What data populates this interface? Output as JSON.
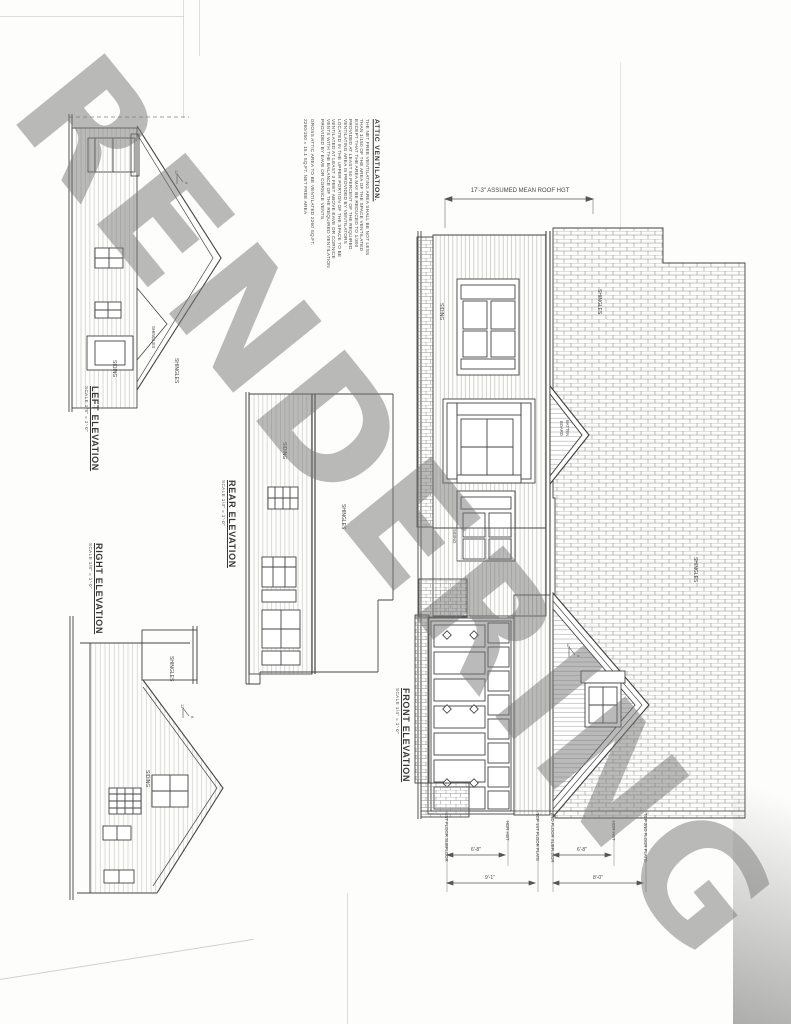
{
  "watermark": "RENDERING",
  "attic_note": {
    "title": "ATTIC VENTILATION.",
    "body_lines": [
      "THE NET FREE VENTILATING AREA SHALL BE NOT LESS",
      "THAN 1/150 OF THE AREA OF THE SPACE VENTILATED",
      "EXCEPT THAT THE AREA MAY BE REDUCED TO 1/300",
      "PROVIDED AT LEAST 50 PERCENT OF THE REQUIRED",
      "VENTILATING AREA IS PROVIDED BY VENTILATORS",
      "LOCATED IN THE UPPER PORTION OF THE SPACE TO BE",
      "VENTILATED AT LEAST 3 FEET ABOVE EAVE OR CORNICE",
      "VENTS WITH THE BALANCE OF THE REQUIRED VENTILATION",
      "PROVIDED BY EAVE OR CORNICE VENTS."
    ],
    "calc_line1": "GROSS ATTIC AREA TO BE VENTILATED 2260 SQ.FT.",
    "calc_line2": "2260/150 = 15.1 SQ.FT. NET FREE AREA"
  },
  "elevations": {
    "left": {
      "title": "LEFT ELEVATION",
      "scale": "SCALE 1/8\" = 1'-0\""
    },
    "right": {
      "title": "RIGHT ELEVATION",
      "scale": "SCALE 1/8\" = 1'-0\""
    },
    "rear": {
      "title": "REAR ELEVATION",
      "scale": "SCALE 1/4\" = 1'-0\""
    },
    "front": {
      "title": "FRONT ELEVATION",
      "scale": "SCALE 1/4\" = 1'-0\""
    }
  },
  "labels": {
    "siding": "SIDING",
    "shingles": "SHINGLES",
    "board": "BOARD",
    "batten": "BATTEN"
  },
  "pitch": {
    "run": "12",
    "rise": "8"
  },
  "dimensions": {
    "roof_height": "17'-3\" ASSUMED MEAN ROOF HGT",
    "first_subfloor": "1ST FLOOR SUBFLOOR",
    "hdr_hgt": "HDR HGT",
    "hdr_dim": "6'-8\"",
    "first_plate": "TOP 1ST FLOOR PLATE",
    "first_height": "9'-1\"",
    "second_subfloor": "2ND FLOOR SUBFLOOR",
    "second_plate": "TOP 2ND FLOOR PLATE",
    "second_height": "8'-0\""
  },
  "colors": {
    "paper": "#fdfdfb",
    "ink": "#3c3c3c",
    "watermark_gray": "#787878"
  }
}
